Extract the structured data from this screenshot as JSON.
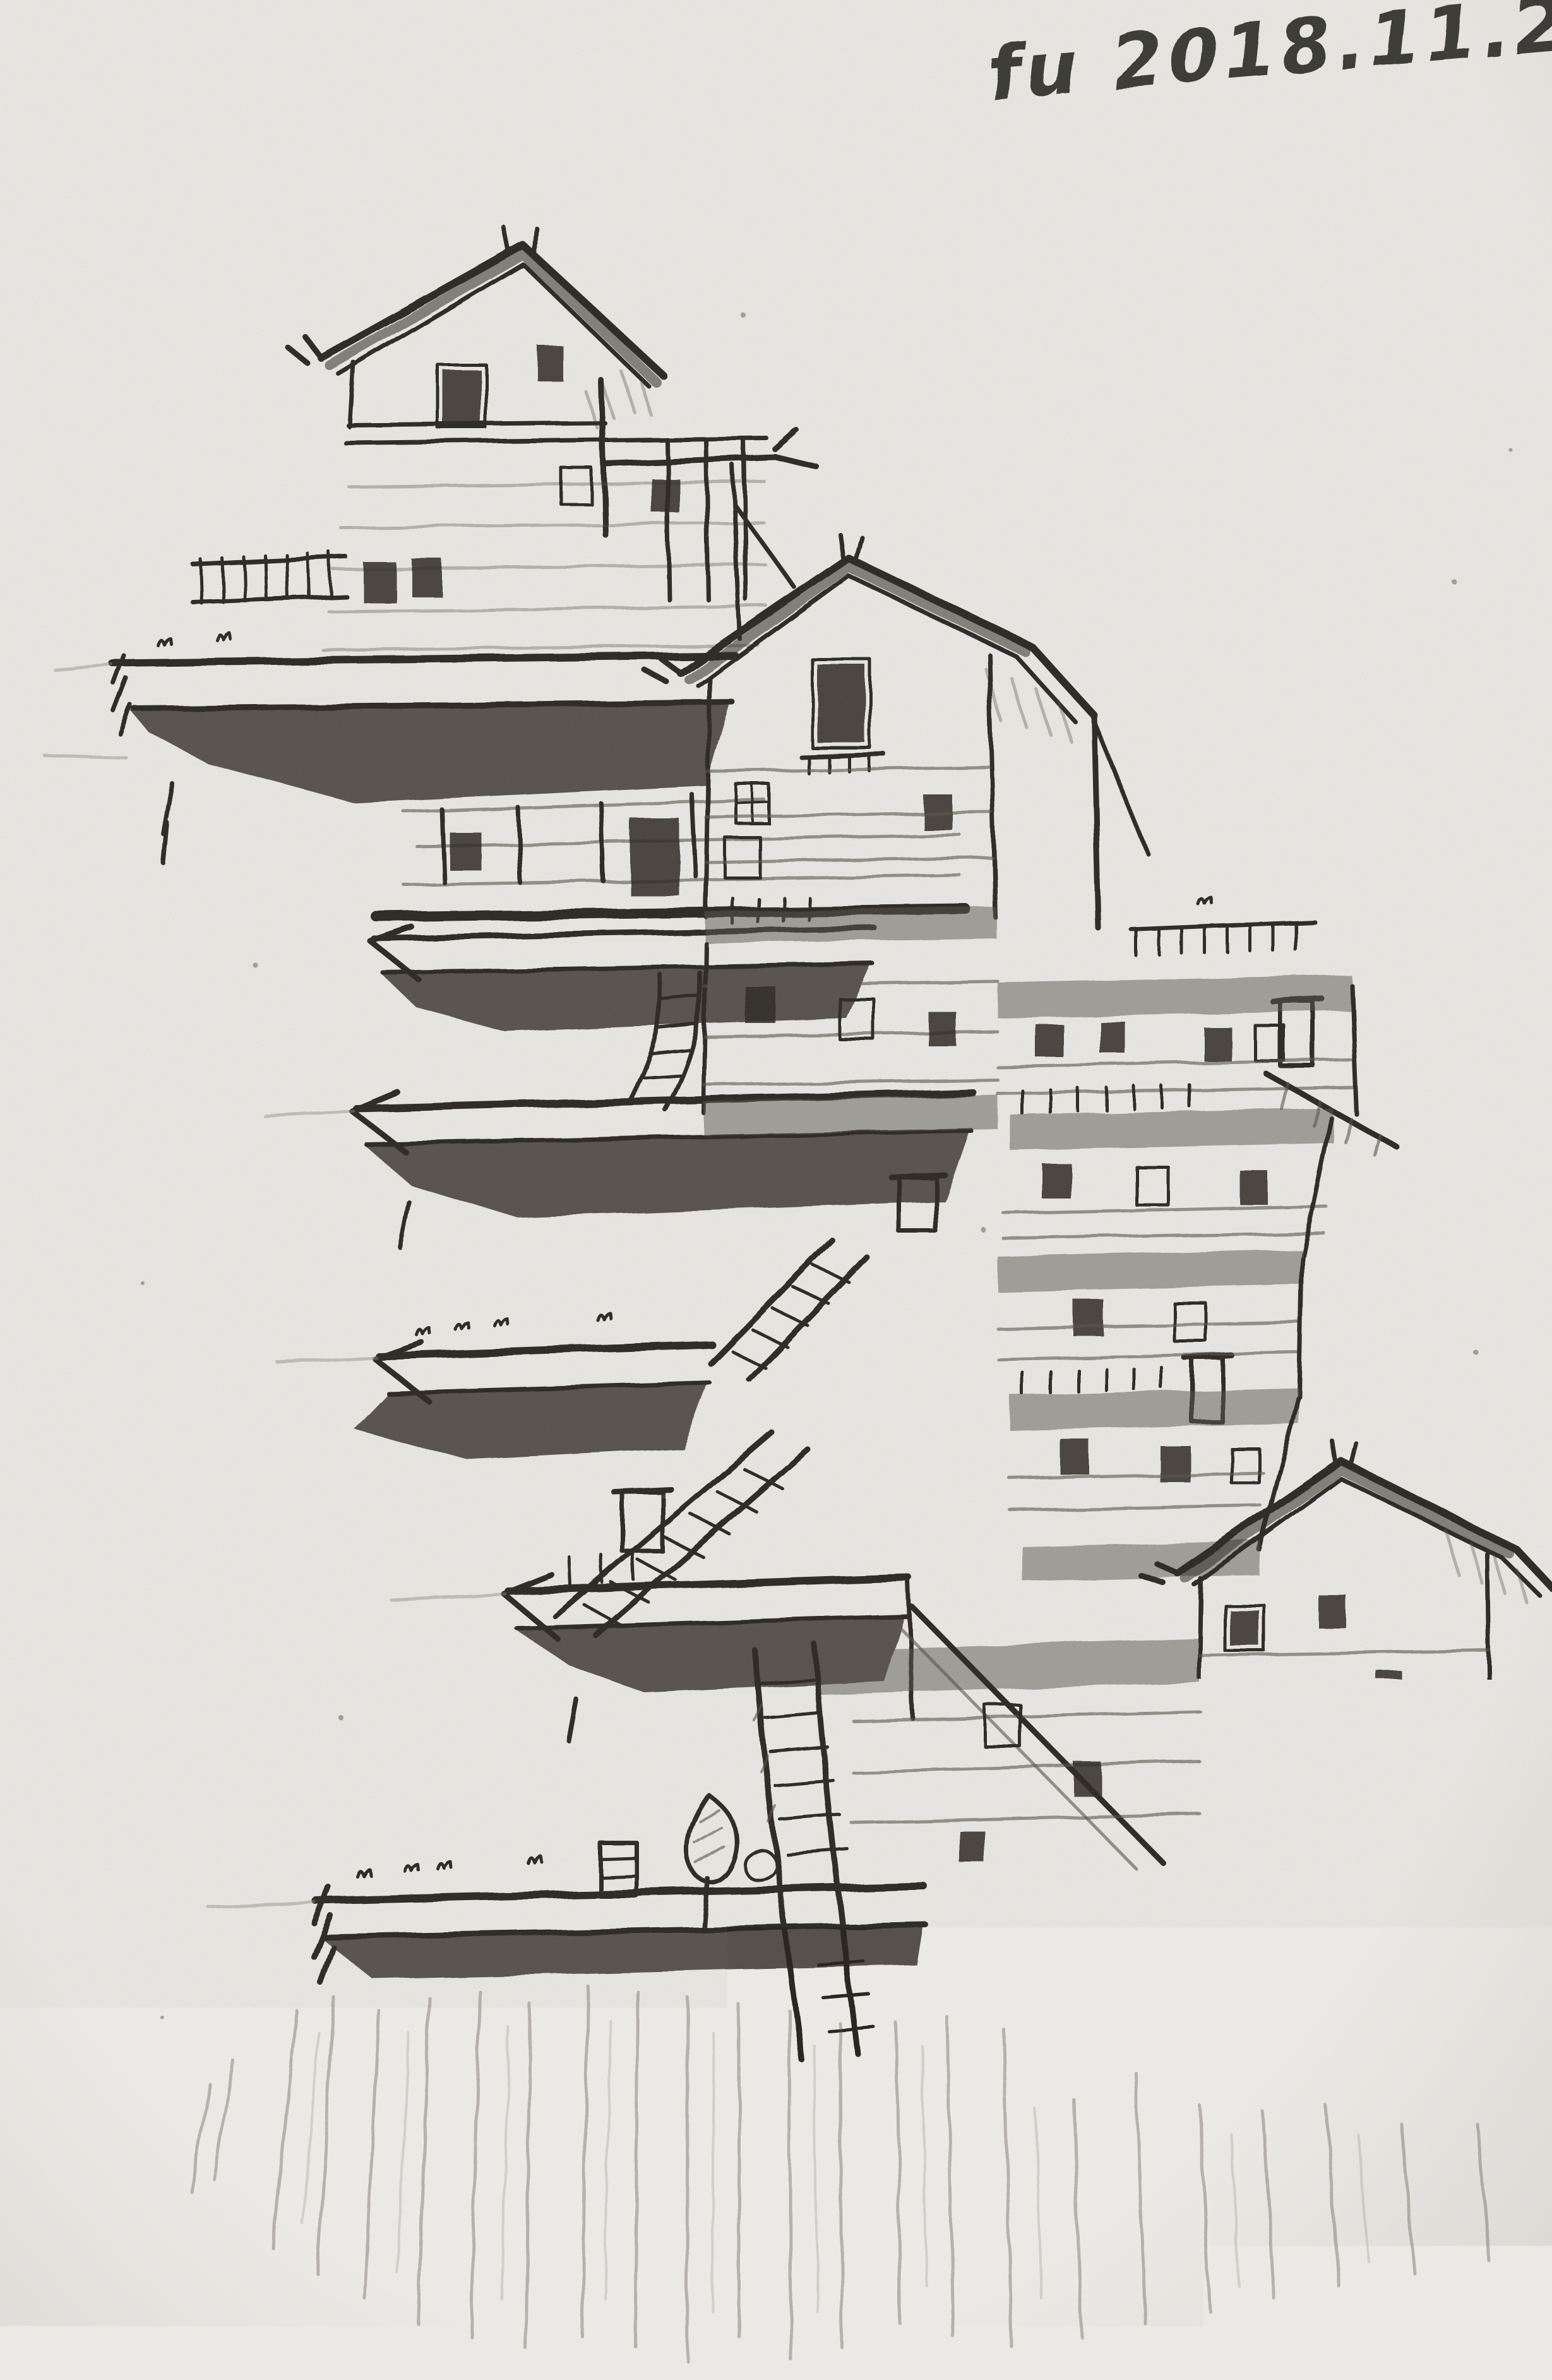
{
  "artwork": {
    "signature": "fu 2018.11.23."
  },
  "palette": {
    "paper": "#ebe9e5",
    "paper_shadow": "#d7d5d0",
    "graphite_dark": "#2a2722",
    "graphite_mid": "#575249",
    "graphite_light": "#8e8a80"
  }
}
